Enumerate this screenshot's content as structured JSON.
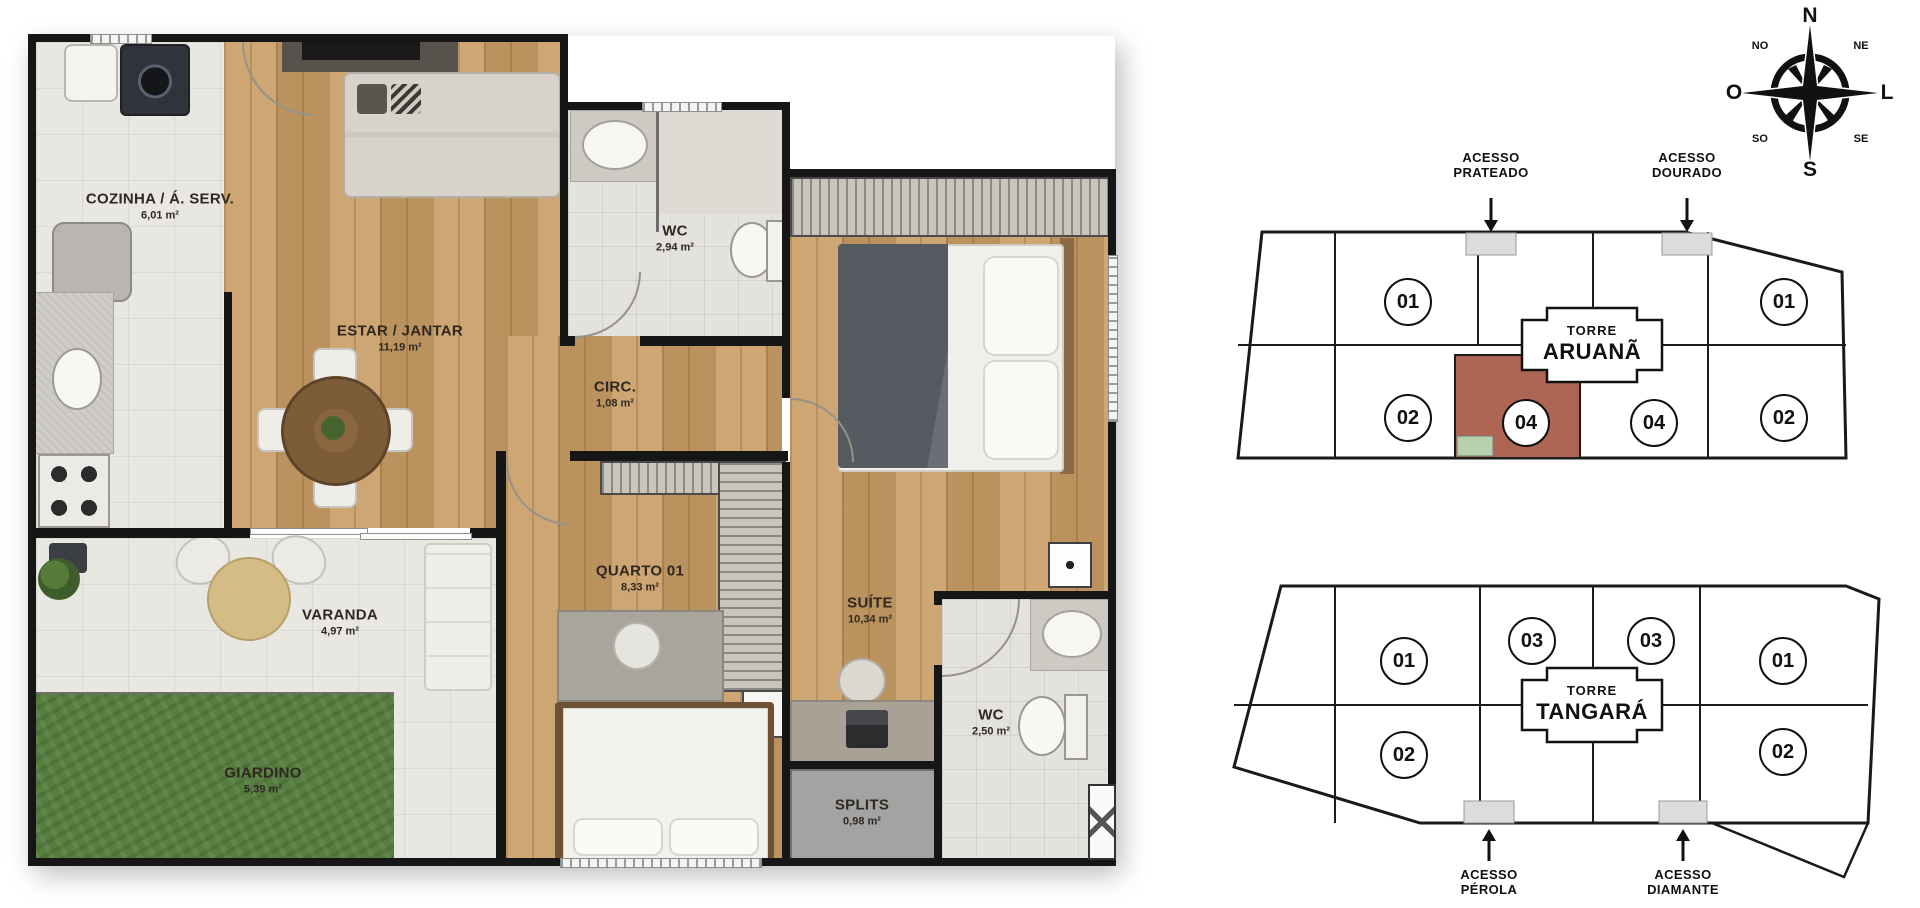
{
  "plan": {
    "rooms": [
      {
        "name": "COZINHA / Á. SERV.",
        "area": "6,01 m²"
      },
      {
        "name": "ESTAR / JANTAR",
        "area": "11,19 m²"
      },
      {
        "name": "WC",
        "area": "2,94 m²"
      },
      {
        "name": "CIRC.",
        "area": "1,08 m²"
      },
      {
        "name": "QUARTO 01",
        "area": "8,33 m²"
      },
      {
        "name": "SUÍTE",
        "area": "10,34 m²"
      },
      {
        "name": "VARANDA",
        "area": "4,97 m²"
      },
      {
        "name": "GIARDINO",
        "area": "5,39 m²"
      },
      {
        "name": "SPLITS",
        "area": "0,98 m²"
      },
      {
        "name": "WC",
        "area": "2,50 m²"
      }
    ]
  },
  "compass": {
    "n": "N",
    "ne": "NE",
    "e": "L",
    "se": "SE",
    "s": "S",
    "sw": "SO",
    "w": "O",
    "nw": "NO"
  },
  "towers": {
    "aruana": {
      "torre_label": "TORRE",
      "name": "ARUANÃ",
      "access_left_line1": "ACESSO",
      "access_left_line2": "PRATEADO",
      "access_right_line1": "ACESSO",
      "access_right_line2": "DOURADO",
      "units": [
        "01",
        "01",
        "02",
        "04",
        "04",
        "02"
      ],
      "highlighted_unit": "04"
    },
    "tangara": {
      "torre_label": "TORRE",
      "name": "TANGARÁ",
      "access_left_line1": "ACESSO",
      "access_left_line2": "PÉROLA",
      "access_right_line1": "ACESSO",
      "access_right_line2": "DIAMANTE",
      "units": [
        "01",
        "03",
        "03",
        "01",
        "02",
        "02"
      ]
    }
  },
  "colors": {
    "highlight_red": "#ae6553",
    "giardino_green": "#b6cfad",
    "access_pad": "#dcdcdc",
    "grass": "#577e40",
    "wall": "#161616"
  }
}
